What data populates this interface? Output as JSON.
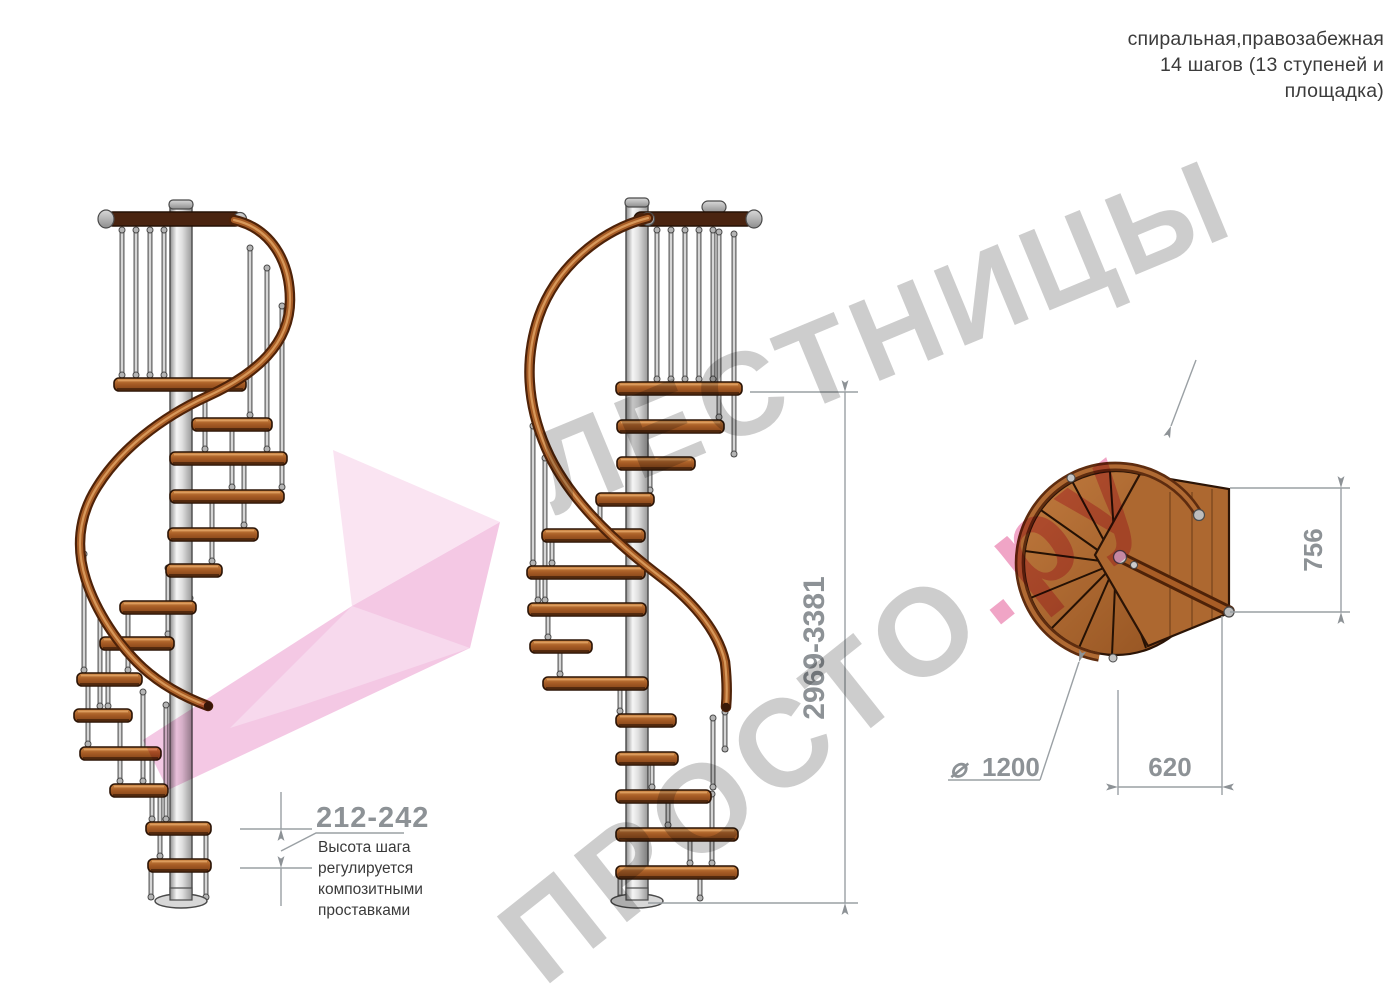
{
  "header": {
    "line1": "спиральная,правозабежная",
    "line2": "14 шагов (13 ступеней и",
    "line3": "площадка)"
  },
  "watermark": {
    "word1": "ЛЕСТНИЦЫ",
    "word2": "ПРОСТО",
    "word2_suffix": ".ру",
    "gray_color": "#c9c9c9",
    "pink_color": "#ef9dc1",
    "arrow_pink_color": "#f2bfe0"
  },
  "dimensions": {
    "height_range": "2969-3381",
    "step_height_range": "212-242",
    "step_height_note_lines": [
      "Высота шага",
      "регулируется",
      "композитными",
      "проставками"
    ],
    "plan_depth": "756",
    "plan_width": "620",
    "diameter_symbol": "⌀",
    "plan_diameter": "1200"
  },
  "palette": {
    "wood_light": "#c8813f",
    "wood_dark": "#7c3f16",
    "rail_dark": "#4e2208",
    "metal_pole": "#e9e9e9",
    "dimension_gray": "#8d9296"
  }
}
